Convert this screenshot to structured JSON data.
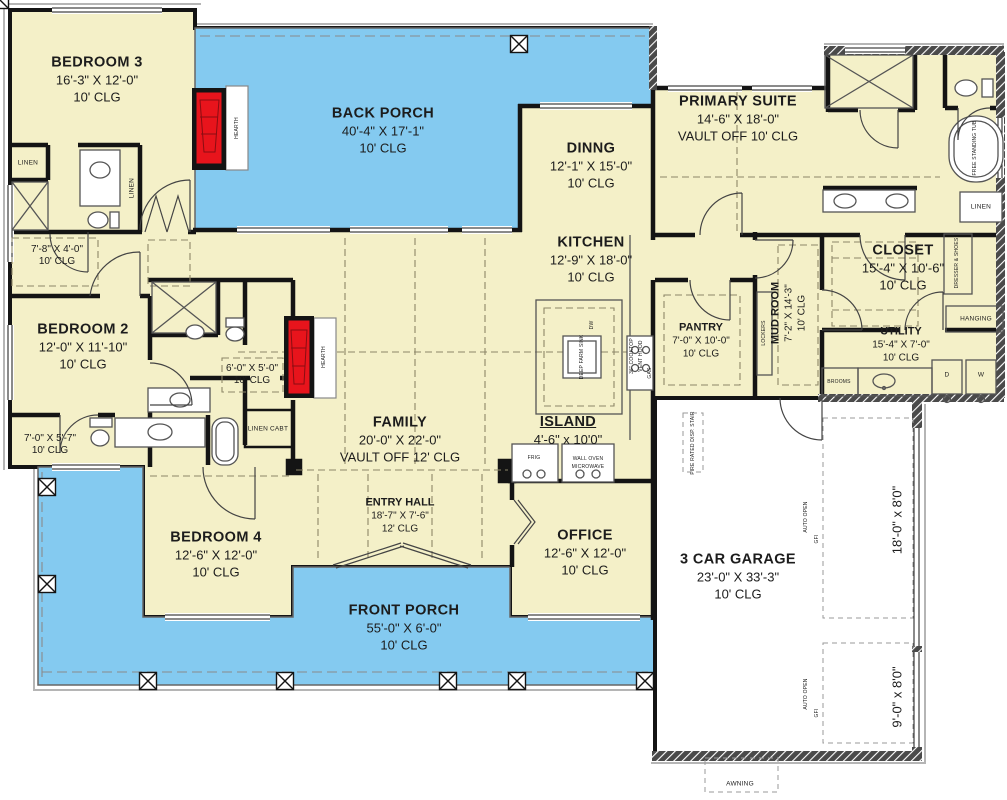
{
  "title": "single-story house floor plan",
  "colors": {
    "house_cream": "#f4f0c8",
    "porch_blue": "#84caf0",
    "wall_black": "#141414",
    "fireplace_red": "#e8141c",
    "roofline_gray": "#b5b5b5",
    "fixture_gray": "#555555",
    "dash_olive": "#8d8668"
  },
  "rooms": [
    {
      "name": "BEDROOM 3",
      "dims": "16'-3\" X 12'-0\"",
      "clg": "10' CLG"
    },
    {
      "name": "BACK PORCH",
      "dims": "40'-4\" X 17'-1\"",
      "clg": "10' CLG"
    },
    {
      "name": "PRIMARY SUITE",
      "dims": "14'-6\" X 18'-0\"",
      "clg": "VAULT OFF 10' CLG"
    },
    {
      "name": "DINNG",
      "dims": "12'-1\" X 15'-0\"",
      "clg": "10' CLG"
    },
    {
      "name": "KITCHEN",
      "dims": "12'-9\" X 18'-0\"",
      "clg": "10' CLG"
    },
    {
      "name": "CLOSET",
      "dims": "15'-4\" X 10'-6\"",
      "clg": "10' CLG"
    },
    {
      "name": "BEDROOM 2",
      "dims": "12'-0\" X 11'-10\"",
      "clg": "10' CLG"
    },
    {
      "name": "PANTRY",
      "dims": "7'-0\" X 10'-0\"",
      "clg": "10' CLG"
    },
    {
      "name": "MUD ROOM",
      "dims": "7'-2\" X 14'-3\"",
      "clg": "10' CLG"
    },
    {
      "name": "UTILITY",
      "dims": "15'-4\" X 7'-0\"",
      "clg": "10' CLG"
    },
    {
      "name": "FAMILY",
      "dims": "20'-0\" X 22'-0\"",
      "clg": "VAULT OFF 12' CLG"
    },
    {
      "name": "ISLAND",
      "dims": "4'-6\" x 10'0\""
    },
    {
      "name": "ENTRY HALL",
      "dims": "18'-7\" X 7'-6\"",
      "clg": "12' CLG"
    },
    {
      "name": "BEDROOM 4",
      "dims": "12'-6\" X 12'-0\"",
      "clg": "10' CLG"
    },
    {
      "name": "OFFICE",
      "dims": "12'-6\" X 12'-0\"",
      "clg": "10' CLG"
    },
    {
      "name": "FRONT PORCH",
      "dims": "55'-0\" X 6'-0\"",
      "clg": "10' CLG"
    },
    {
      "name": "3 CAR GARAGE",
      "dims": "23'-0\" X 33'-3\"",
      "clg": "10' CLG"
    }
  ],
  "small_rooms": [
    {
      "dims": "7'-8\" X 4'-0\"",
      "clg": "10' CLG"
    },
    {
      "dims": "6'-0\" X 5'-0\"",
      "clg": "10' CLG"
    },
    {
      "dims": "7'-0\" X 5'-7\"",
      "clg": "10' CLG"
    }
  ],
  "garage_doors": [
    {
      "dims": "18'-0\" x 8'0\""
    },
    {
      "dims": "9'-0\" x 8'0\""
    }
  ],
  "tags": {
    "linen": "LINEN",
    "linen_cabt": "LINEN CABT",
    "hanging": "HANGING",
    "dresser_shoes": "DRESSER & SHOES",
    "lockers": "LOCKERS",
    "brooms": "BROOMS",
    "hearth": "HEARTH",
    "free_standing_tub": "FREE STANDING TUB",
    "frig": "FRIG",
    "wall_oven": "WALL OVEN",
    "microwave": "MICROWAVE",
    "dryer": "D",
    "washer": "W",
    "deep_farm_sink": "DEEP FARM SINK",
    "dw": "DW",
    "cooktop": "36\" COOKTOP",
    "vent_hood": "VENT HOOD",
    "gas": "GAS",
    "auto_open": "AUTO OPEN",
    "gfi": "GFI",
    "fire_rated_stair": "FIRE RATED DISP. STAIR",
    "awning": "AWNING"
  }
}
